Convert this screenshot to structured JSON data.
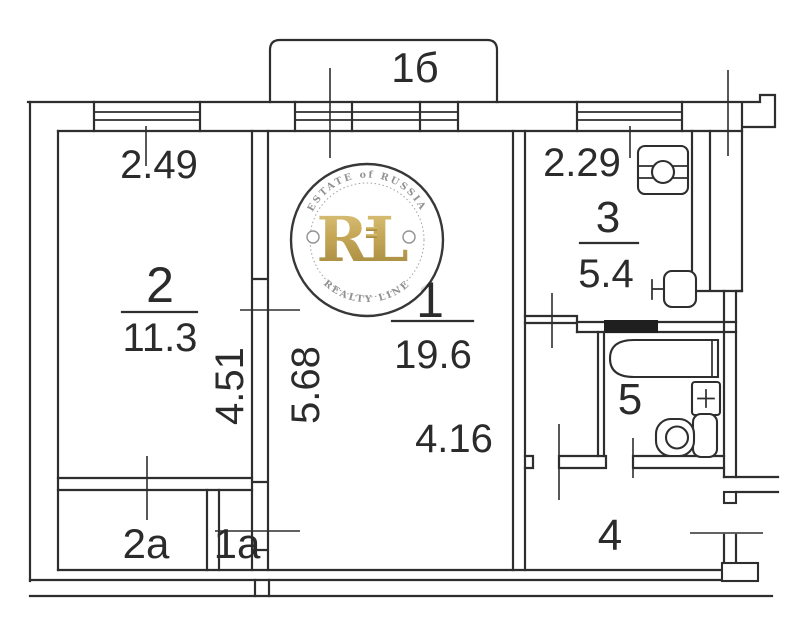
{
  "floorplan": {
    "balcony": {
      "label": "1б"
    },
    "rooms": {
      "r1": {
        "number": "1",
        "area": "19.6"
      },
      "r2": {
        "number": "2",
        "area": "11.3"
      },
      "r3": {
        "number": "3",
        "area": "5.4"
      },
      "r4": {
        "number": "4"
      },
      "r5": {
        "number": "5"
      },
      "r2a": {
        "number": "2a"
      },
      "r1a": {
        "number": "1a"
      }
    },
    "dimensions": {
      "room2_width": "2.49",
      "room2_depth": "4.51",
      "room1_depth": "5.68",
      "room1_width": "4.16",
      "kitchen_width": "2.29"
    },
    "colors": {
      "line": "#2e2e2e",
      "black_wall": "#1f1f1f"
    }
  },
  "watermark": {
    "arc_top": "ESTATE of RUSSIA",
    "initials": "RL",
    "arc_bottom": "REALTY LINE",
    "gold": "#c2a14b"
  }
}
